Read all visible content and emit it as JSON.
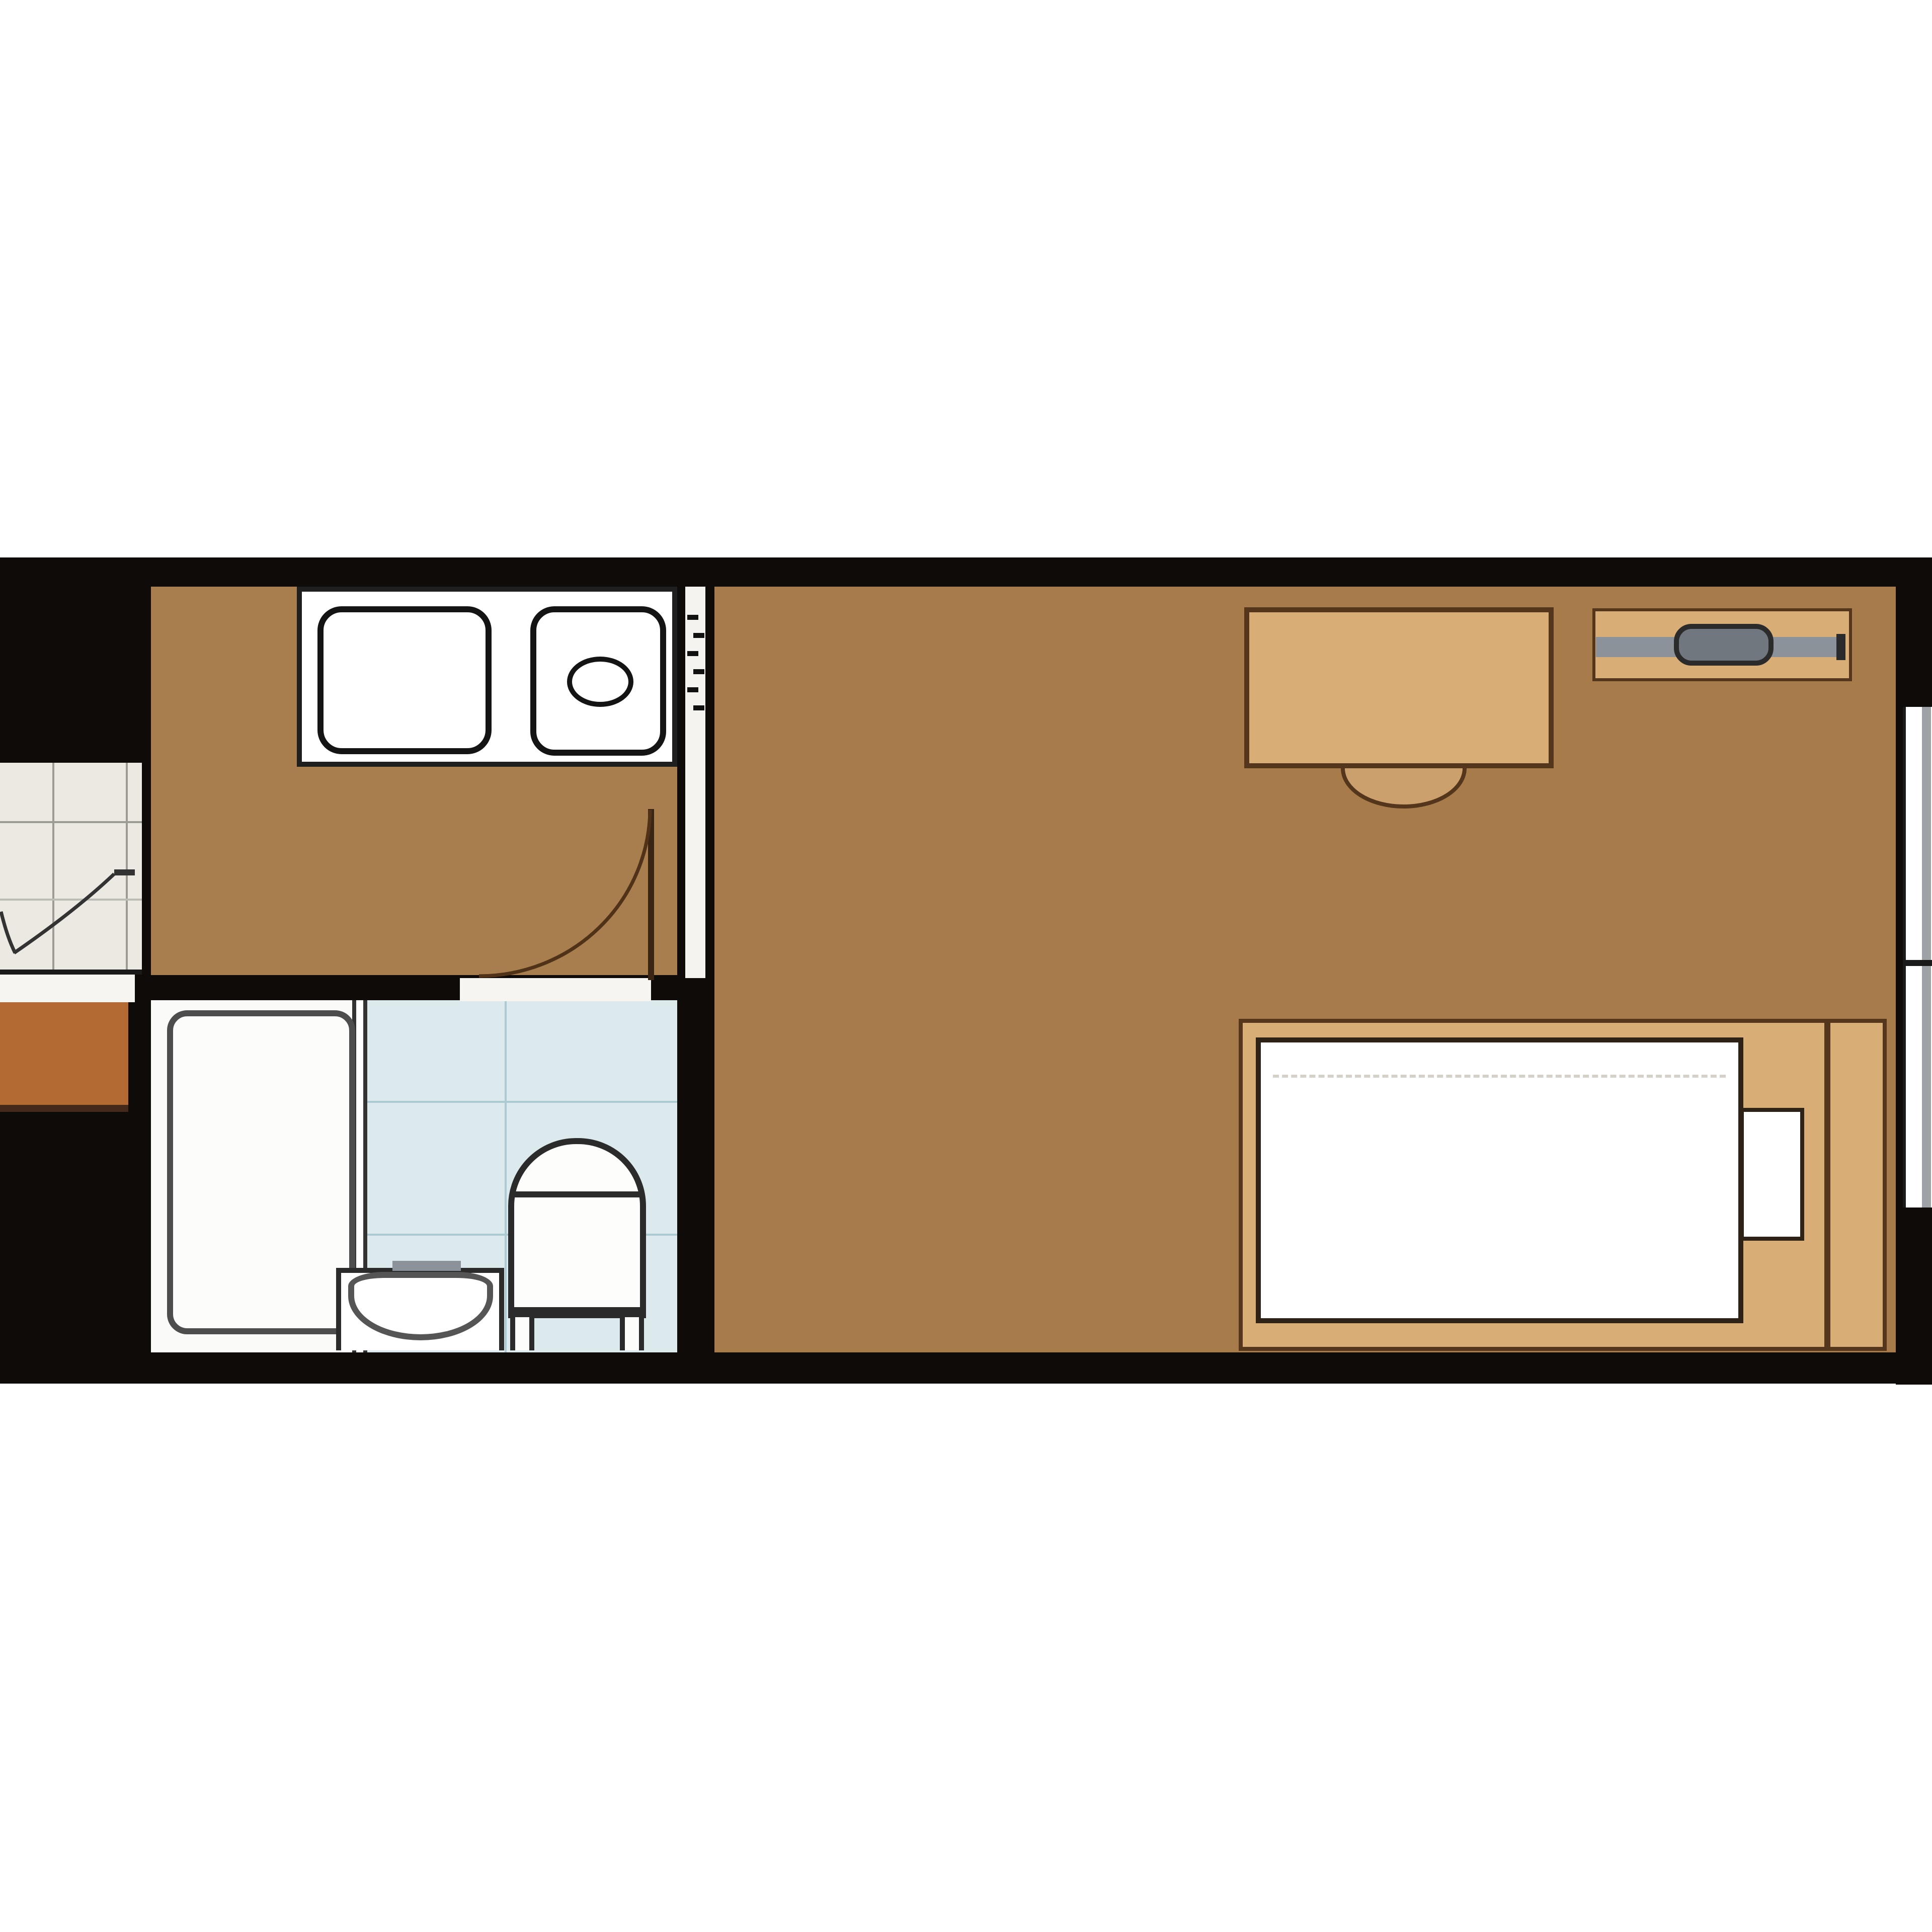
{
  "document": {
    "kind": "apartment-floor-plan",
    "visible_text": "",
    "orientation": "horizontal-band"
  },
  "palette": {
    "background": "#ffffff",
    "wall_black": "#0e0b08",
    "floor_wood": "#a77c4a",
    "furniture_tan": "#d8ad76",
    "chair_tan": "#cba06c",
    "outline_brown": "#53361c",
    "fixture_outline": "#1f1f1f",
    "tub_outline": "#4d4d4d",
    "bath_floor_white": "#fafaf8",
    "washroom_blue": "#ddeaed",
    "washroom_grid": "#abcad1",
    "corridor_tile": "#ece9e3",
    "tile_grid": "#9d9c94",
    "entry_orange": "#b46a33",
    "rail_gray": "#8b929a",
    "knob_gray": "#70777f",
    "window_gray": "#9da2a7",
    "door_arc": "#4f3217"
  },
  "rooms": [
    {
      "id": "kitchen",
      "label": "kitchen",
      "floor": "#a77c4a"
    },
    {
      "id": "main-room",
      "label": "main room",
      "floor": "#a77c4a"
    },
    {
      "id": "bathroom",
      "label": "bathroom",
      "floor": "#fafaf8"
    },
    {
      "id": "washroom-toilet",
      "label": "washroom / toilet",
      "floor": "#ddeaed"
    },
    {
      "id": "corridor",
      "label": "adjacent corridor / entry",
      "floor": "#ece9e3"
    }
  ],
  "fixtures": [
    "kitchen-counter",
    "sink-basin-large",
    "sink-basin-small",
    "sink-drain",
    "swing-door-kitchen",
    "sliding-partition",
    "corridor-door",
    "bathtub",
    "washbasin",
    "washbasin-bowl",
    "toilet",
    "desk",
    "chair",
    "hanger-rack",
    "hanger-rail",
    "hanger-knob",
    "bed-frame",
    "mattress",
    "pillow",
    "window-sliding"
  ]
}
